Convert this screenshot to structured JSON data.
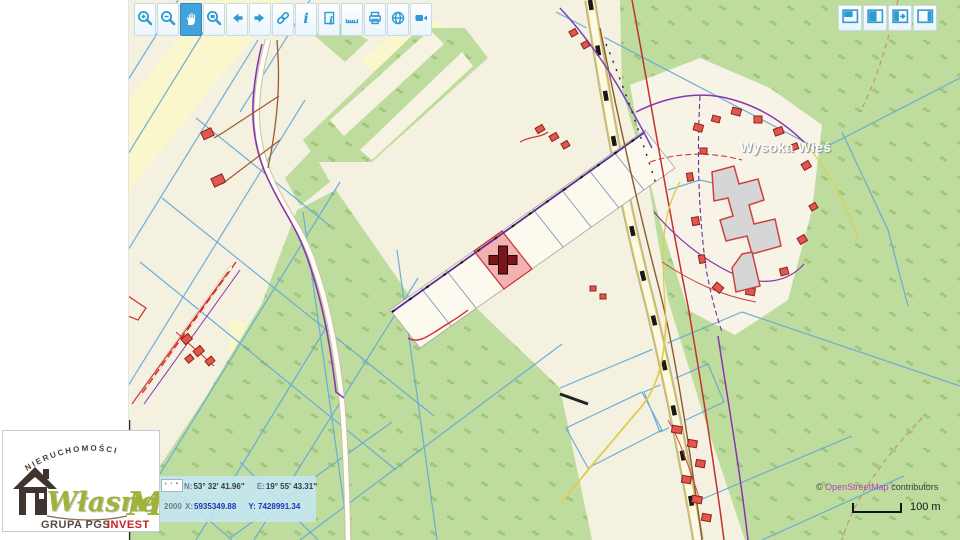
{
  "map": {
    "place_label": "Wysoka Wieś"
  },
  "toolbar": {
    "buttons": [
      {
        "name": "zoom-in",
        "icon": "magnifier-plus-icon",
        "active": false
      },
      {
        "name": "zoom-out",
        "icon": "magnifier-minus-icon",
        "active": false
      },
      {
        "name": "pan",
        "icon": "hand-icon",
        "active": true
      },
      {
        "name": "zoom-window",
        "icon": "magnifier-box-icon",
        "active": false
      },
      {
        "name": "previous-view",
        "icon": "arrow-left-icon",
        "active": false
      },
      {
        "name": "next-view",
        "icon": "arrow-right-icon",
        "active": false
      },
      {
        "name": "link",
        "icon": "chain-icon",
        "active": false
      },
      {
        "name": "info",
        "icon": "italic-i-icon",
        "active": false
      },
      {
        "name": "page-info",
        "icon": "page-with-i-icon",
        "active": false
      },
      {
        "name": "measure",
        "icon": "ruler-icon",
        "active": false
      },
      {
        "name": "print",
        "icon": "printer-icon",
        "active": false
      },
      {
        "name": "globe",
        "icon": "globe-icon",
        "active": false
      },
      {
        "name": "video",
        "icon": "camera-icon",
        "active": false
      }
    ]
  },
  "panel_buttons": [
    {
      "name": "panel-layout-top",
      "icon": "panel-top-left-filled-icon"
    },
    {
      "name": "panel-layout-left",
      "icon": "panel-left-filled-icon"
    },
    {
      "name": "panel-expand",
      "icon": "panel-arrow-right-icon"
    },
    {
      "name": "panel-layout-right",
      "icon": "panel-right-filled-icon"
    }
  ],
  "coordinates": {
    "format_symbols": "° ' \"",
    "row1": {
      "label_n": "N:",
      "value_n": "53° 32' 41.96\"",
      "label_e": "E:",
      "value_e": "19° 55' 43.31\""
    },
    "row2": {
      "system": "2000",
      "label_x": "X:",
      "value_x": "5935349.88",
      "label_y": "Y:",
      "value_y": "7428991.34"
    }
  },
  "scale": {
    "label": "100 m"
  },
  "attribution": {
    "prefix": "©",
    "link": "OpenStreetMap",
    "suffix": "contributors"
  },
  "logo": {
    "arc_text": "NIERUCHOMOŚCI",
    "script_text": "Własne",
    "initial": "M",
    "group_text": "GRUPA PGS",
    "brand_text": "INVEST"
  },
  "colors": {
    "accent_blue": "#2f99d4",
    "selected_parcel": "#f2b2b2",
    "marker_dark_red": "#7d1418",
    "osm_link": "#b145b1",
    "forest_green": "#bedc9e",
    "cadastral_blue": "#64a8d8"
  }
}
